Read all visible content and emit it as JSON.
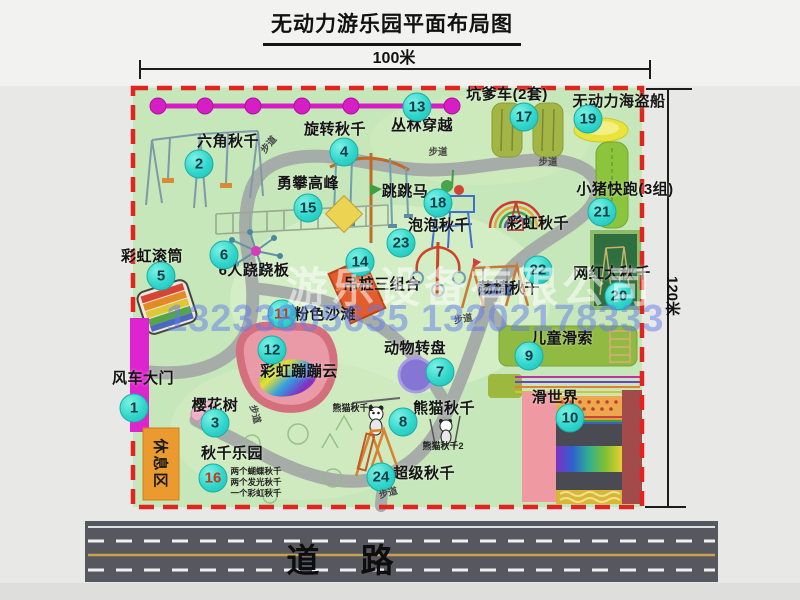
{
  "title": "无动力游乐园平面布局图",
  "dimensions": {
    "width": "100米",
    "height": "120米"
  },
  "road_label": "道  路",
  "rest_area_label": "休息区",
  "trail_label": "步道",
  "watermark": {
    "company": "游乐设备有限公司",
    "phone": "13233805635 13202178333"
  },
  "colors": {
    "badge": "#31d6cb",
    "boundary": "#e0241e",
    "map_green": "#c6e7b9",
    "gate_magenta": "#de25cd",
    "road_gray": "#57575f",
    "rest_orange": "#eb9a30"
  },
  "map": {
    "attractions": [
      {
        "num": 1,
        "name": "风车大门",
        "bx": 134,
        "by": 408,
        "lx": 143,
        "ly": 371
      },
      {
        "num": 2,
        "name": "六角秋千",
        "bx": 199,
        "by": 164,
        "lx": 228,
        "ly": 134
      },
      {
        "num": 3,
        "name": "樱花树",
        "bx": 215,
        "by": 423,
        "lx": 215,
        "ly": 398
      },
      {
        "num": 4,
        "name": "旋转秋千",
        "bx": 344,
        "by": 152,
        "lx": 335,
        "ly": 122
      },
      {
        "num": 5,
        "name": "彩虹滚筒",
        "bx": 161,
        "by": 276,
        "lx": 152,
        "ly": 249
      },
      {
        "num": 6,
        "name": "6人跷跷板",
        "bx": 224,
        "by": 255,
        "lx": 254,
        "ly": 263
      },
      {
        "num": 7,
        "name": "动物转盘",
        "bx": 440,
        "by": 372,
        "lx": 415,
        "ly": 341
      },
      {
        "num": 8,
        "name": "熊猫秋千",
        "bx": 403,
        "by": 422,
        "lx": 444,
        "ly": 401
      },
      {
        "num": 9,
        "name": "儿童滑索",
        "bx": 529,
        "by": 356,
        "lx": 562,
        "ly": 331
      },
      {
        "num": 10,
        "name": "滑世界",
        "bx": 570,
        "by": 418,
        "lx": 555,
        "ly": 390
      },
      {
        "num": 11,
        "name": "粉色沙滩",
        "bx": 282,
        "by": 314,
        "lx": 325,
        "ly": 307,
        "nc": "#c2391b"
      },
      {
        "num": 12,
        "name": "彩虹蹦蹦云",
        "bx": 272,
        "by": 350,
        "lx": 299,
        "ly": 364
      },
      {
        "num": 13,
        "name": "丛林穿越",
        "bx": 417,
        "by": 107,
        "lx": 422,
        "ly": 118
      },
      {
        "num": 14,
        "name": "吊桩三组合",
        "bx": 360,
        "by": 262,
        "lx": 382,
        "ly": 277
      },
      {
        "num": 15,
        "name": "勇攀高峰",
        "bx": 308,
        "by": 208,
        "lx": 308,
        "ly": 176
      },
      {
        "num": 16,
        "name": "秋千乐园",
        "bx": 213,
        "by": 478,
        "lx": 232,
        "ly": 446,
        "nc": "#c2391b"
      },
      {
        "num": 17,
        "name": "坑爹车(2套)",
        "bx": 524,
        "by": 117,
        "lx": 507,
        "ly": 87
      },
      {
        "num": 18,
        "name": "跳跳马",
        "bx": 438,
        "by": 203,
        "lx": 405,
        "ly": 184
      },
      {
        "num": 19,
        "name": "无动力海盗船",
        "bx": 588,
        "by": 119,
        "lx": 619,
        "ly": 94
      },
      {
        "num": 20,
        "name": "网红大秋千",
        "bx": 619,
        "by": 296,
        "lx": 612,
        "ly": 266
      },
      {
        "num": 21,
        "name": "小猪快跑(3组)",
        "bx": 602,
        "by": 212,
        "lx": 625,
        "ly": 182
      },
      {
        "num": 22,
        "name": "荡椅秋千",
        "bx": 538,
        "by": 270,
        "lx": 509,
        "ly": 281
      },
      {
        "num": 23,
        "name": "泡泡秋千",
        "bx": 401,
        "by": 243,
        "lx": 439,
        "ly": 218
      },
      {
        "num": 24,
        "name": "超级秋千",
        "bx": 381,
        "by": 477,
        "lx": 424,
        "ly": 466
      }
    ],
    "plain_labels": [
      {
        "text": "彩虹秋千",
        "x": 538,
        "y": 216
      }
    ],
    "sub_labels": [
      {
        "text": "熊猫秋千1",
        "x": 353,
        "y": 404,
        "s": 9
      },
      {
        "text": "熊猫秋千2",
        "x": 443,
        "y": 442,
        "s": 9
      },
      {
        "text": "两个蝴蝶秋千",
        "x": 256,
        "y": 467,
        "s": 8.5
      },
      {
        "text": "两个发光秋千",
        "x": 256,
        "y": 478,
        "s": 8.5
      },
      {
        "text": "一个彩虹秋千",
        "x": 256,
        "y": 489,
        "s": 8.5
      }
    ],
    "trail_marks": [
      {
        "x": 268,
        "y": 144,
        "rot": -50
      },
      {
        "x": 438,
        "y": 151,
        "rot": 0
      },
      {
        "x": 548,
        "y": 161,
        "rot": 0
      },
      {
        "x": 463,
        "y": 318,
        "rot": -10
      },
      {
        "x": 256,
        "y": 414,
        "rot": 75
      },
      {
        "x": 388,
        "y": 492,
        "rot": -15
      }
    ]
  }
}
